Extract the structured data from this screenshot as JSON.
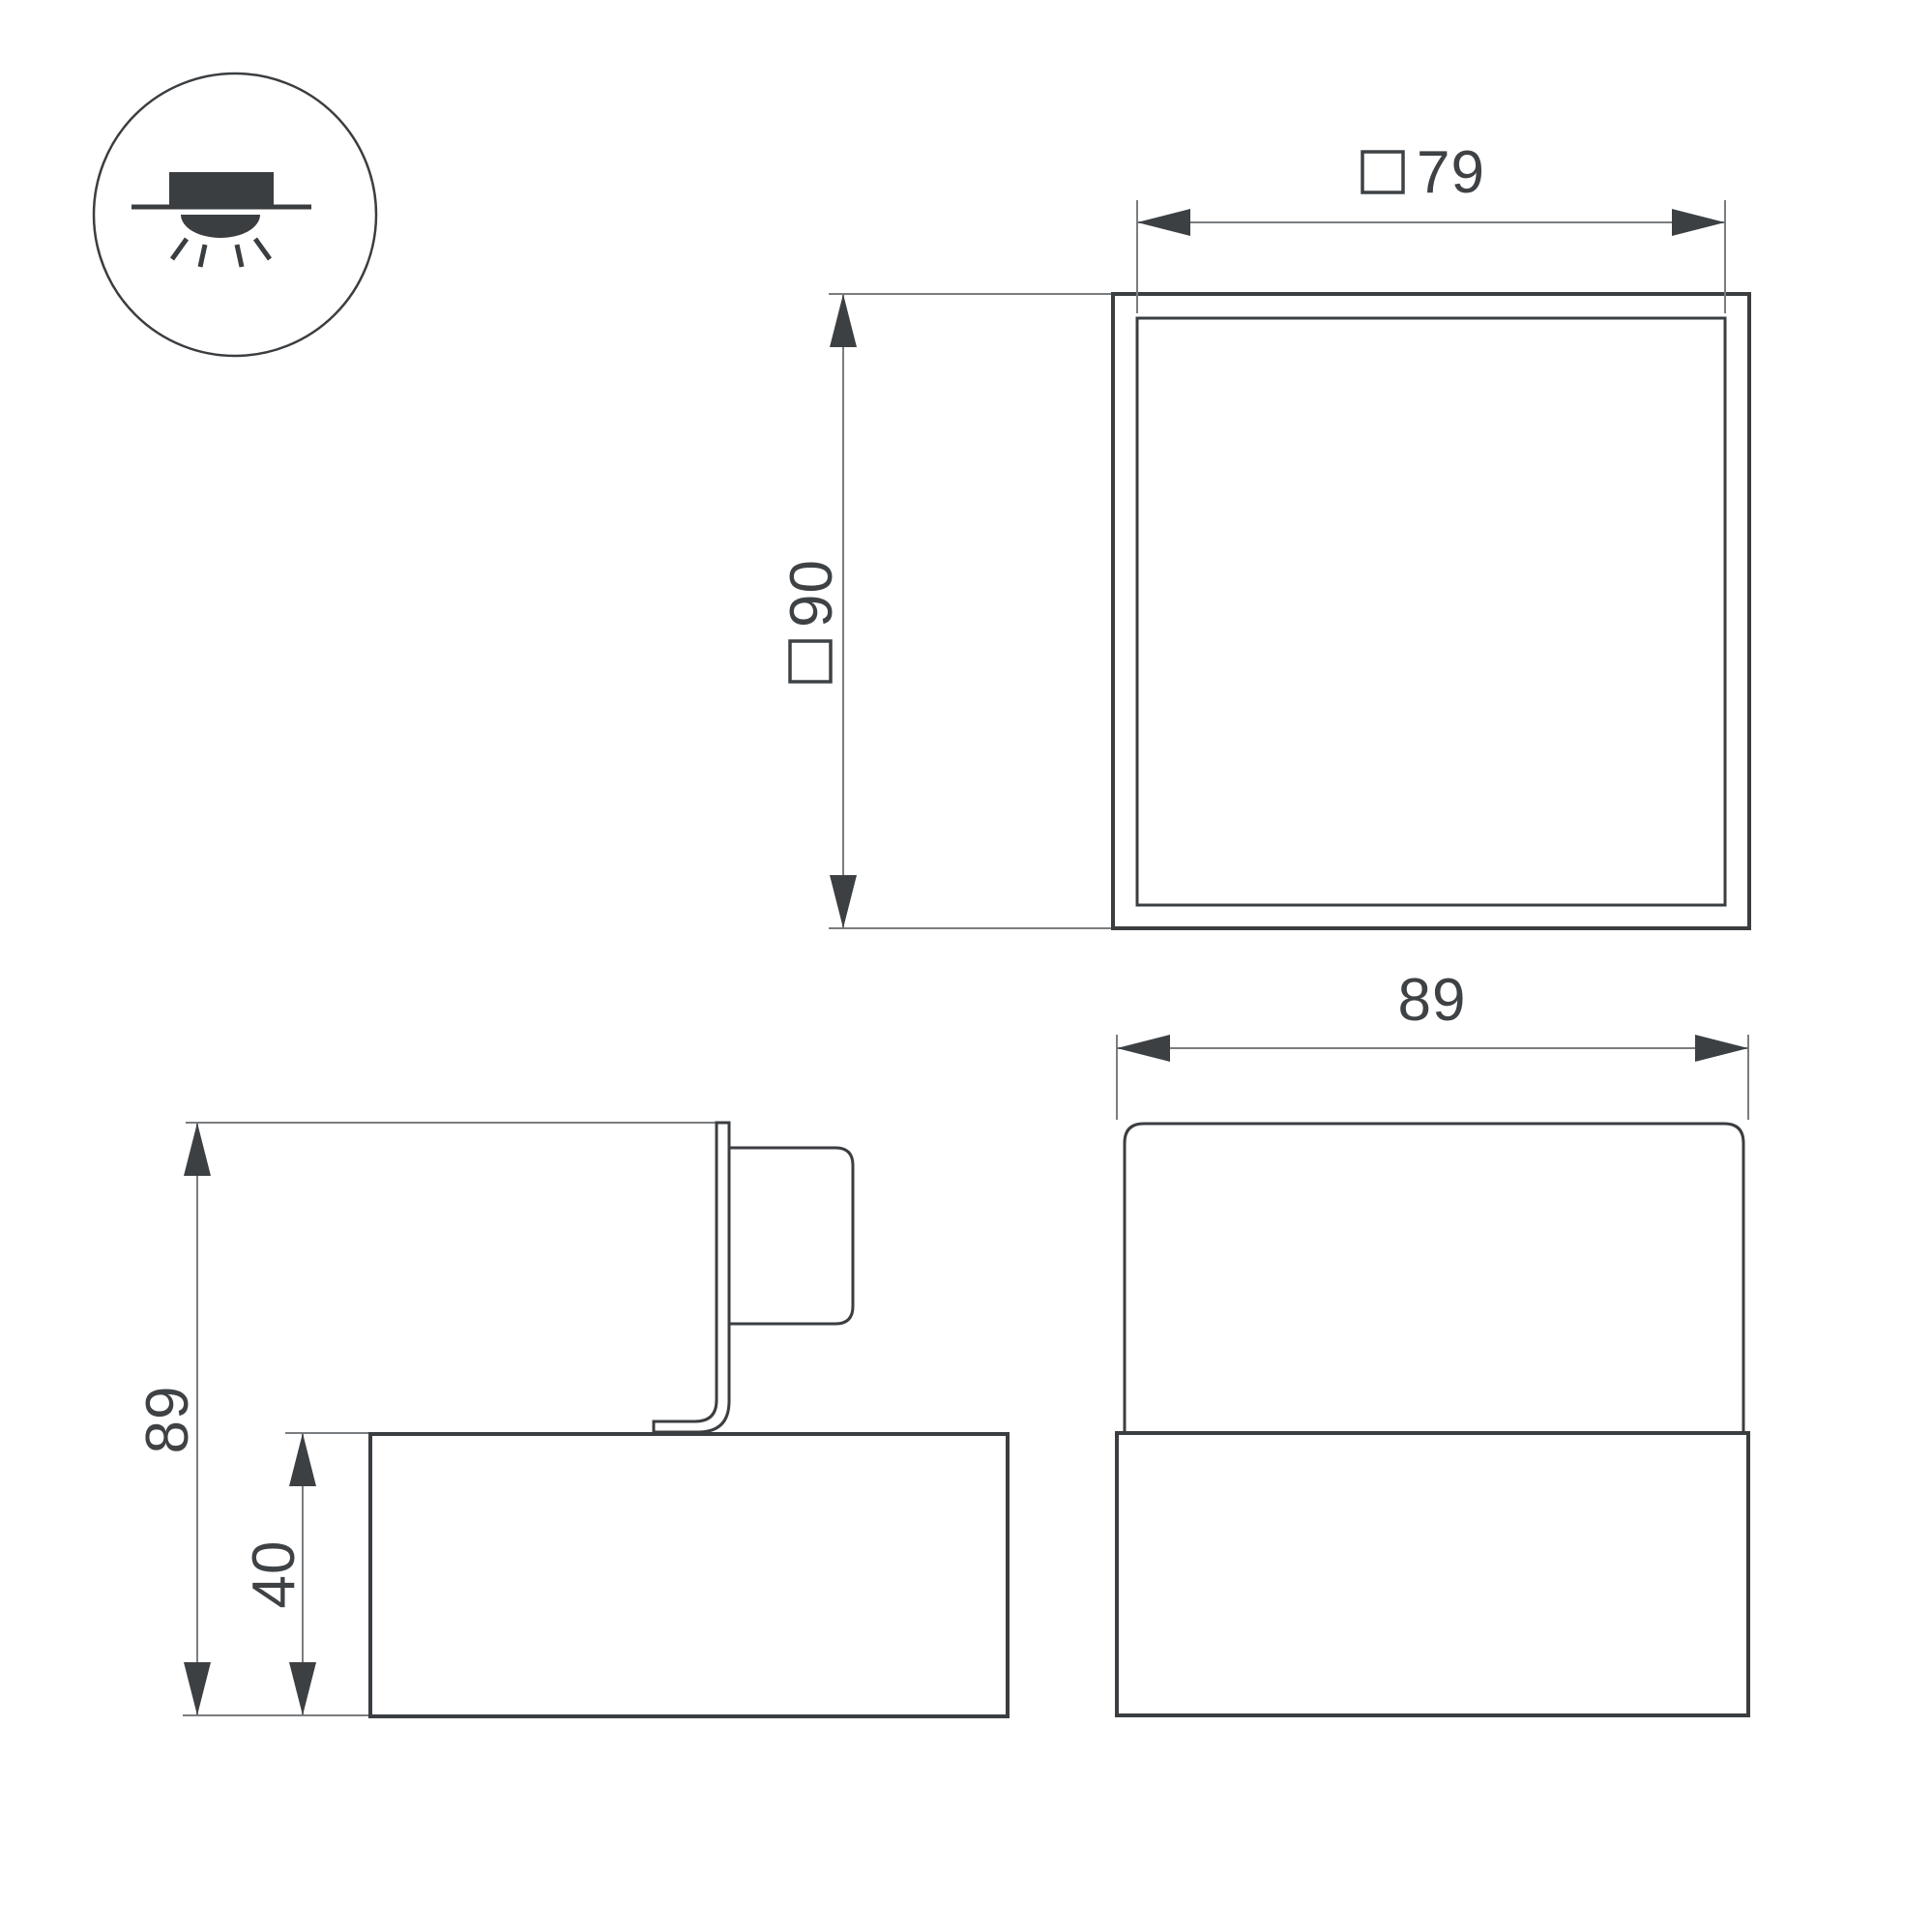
{
  "colors": {
    "outline": "#3b3e41",
    "thin": "#7a7d80",
    "arrow": "#3d4043",
    "text": "#3f4245",
    "background": "#ffffff"
  },
  "icon": {
    "name": "surface-downlight-icon"
  },
  "top_view": {
    "width": {
      "prefix": "□",
      "value": "79"
    },
    "size": {
      "prefix": "□",
      "value": "90"
    }
  },
  "side_view": {
    "overall_height": {
      "value": "89"
    },
    "base_height": {
      "value": "40"
    }
  },
  "front_view": {
    "overall_width": {
      "value": "89"
    }
  }
}
